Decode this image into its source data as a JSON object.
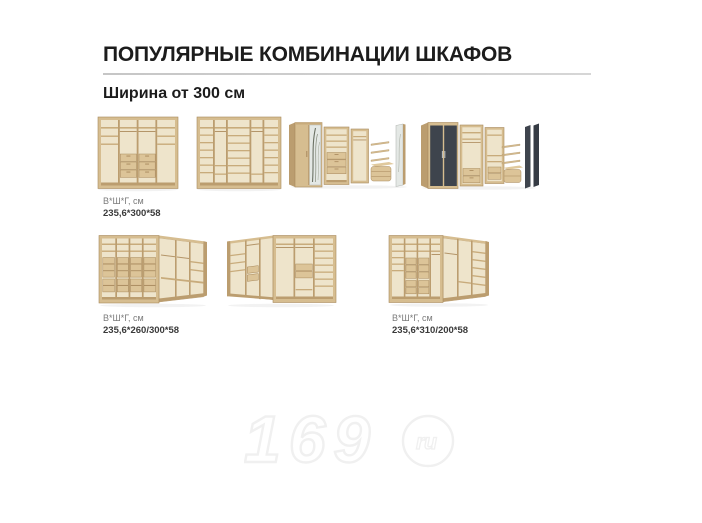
{
  "page": {
    "title": "ПОПУЛЯРНЫЕ КОМБИНАЦИИ ШКАФОВ",
    "subtitle": "Ширина от 300 см"
  },
  "rows": [
    {
      "items": [
        "straight-wardrobe-with-drawers",
        "straight-wardrobe-with-shelves",
        "combination-with-mirror-door",
        "combination-with-graphite-doors"
      ],
      "labels": [
        {
          "caption": "В*Ш*Г, см",
          "dimensions": "235,6*300*58"
        }
      ]
    },
    {
      "items": [
        "corner-wardrobe-left",
        "corner-wardrobe-center",
        "corner-wardrobe-right"
      ],
      "labels": [
        {
          "caption": "В*Ш*Г, см",
          "dimensions": "235,6*260/300*58"
        },
        {
          "caption": "В*Ш*Г, см",
          "dimensions": "235,6*310/200*58"
        }
      ]
    }
  ],
  "watermark": {
    "text": "169",
    "domain": "ru"
  },
  "colors": {
    "background": "#ffffff",
    "title_text": "#1c1c1c",
    "divider": "#cccccc",
    "label_caption": "#7b7b7b",
    "label_value": "#3a3a3a",
    "wood": "#d6bd90",
    "wood_edge": "#bb9d6f",
    "interior": "#eee4cb",
    "graphite_door": "#3e444d",
    "mirror": "#e4e8e5",
    "watermark": "#f0f0f0"
  }
}
